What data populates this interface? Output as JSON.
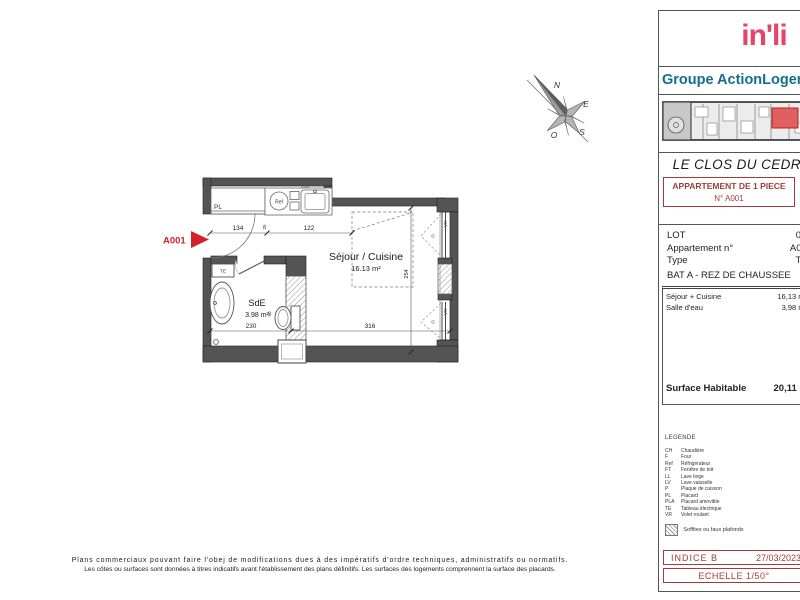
{
  "header": {
    "logo_text": "in'li",
    "logo_badge": "AL",
    "group_name": "Groupe ActionLogement"
  },
  "doc": {
    "project_title": "LE CLOS DU CEDRE",
    "apt_line1": "APPARTEMENT DE 1 PIECE",
    "apt_line2": "N° A001"
  },
  "info": {
    "lot_label": "LOT",
    "lot_value": "01",
    "apt_label": "Appartement n°",
    "apt_value": "A001",
    "type_label": "Type",
    "type_value": "T1",
    "bat_line": "BAT A - REZ DE CHAUSSEE"
  },
  "surfaces": {
    "rows": [
      {
        "label": "Séjour + Cuisine",
        "value": "16,13 m²"
      },
      {
        "label": "Salle d'eau",
        "value": "3,98 m²"
      }
    ],
    "total_label": "Surface Habitable",
    "total_value": "20,11 m²"
  },
  "legend": {
    "title": "LEGENDE",
    "items": [
      {
        "code": "CH",
        "label": "Chaudière"
      },
      {
        "code": "F",
        "label": "Four"
      },
      {
        "code": "Ref",
        "label": "Réfrigérateur"
      },
      {
        "code": "FT",
        "label": "Fenêtre de toit"
      },
      {
        "code": "LL",
        "label": "Lave linge"
      },
      {
        "code": "LV",
        "label": "Lave vaisselle"
      },
      {
        "code": "P",
        "label": "Plaque de cuisson"
      },
      {
        "code": "PL",
        "label": "Placard"
      },
      {
        "code": "PLA",
        "label": "Placard amovible"
      },
      {
        "code": "TE",
        "label": "Tableau électrique"
      },
      {
        "code": "VR",
        "label": "Volet roulant"
      }
    ],
    "soffites": "Soffites ou faux plafonds"
  },
  "revision": {
    "indice": "INDICE  B",
    "date": "27/03/2023",
    "echelle": "ECHELLE 1/50°"
  },
  "disclaimer": {
    "line1": "Plans commerciaux pouvant faire l'obej de modifications dues à des impératifs d'ordre techniques, administratifs ou normatifs.",
    "line2": "Les côtes ou surfaces sont données à titres indicatifs avant l'établissement des plans définitifs. Les surfaces des logements comprennent la surface des placards."
  },
  "plan": {
    "unit": "A001",
    "sejour_name": "Séjour / Cuisine",
    "sejour_area": "16.13 m²",
    "sde_name": "SdE",
    "sde_area": "3.98 m²",
    "labels": {
      "pl": "PL",
      "ref": "Ref",
      "te": "TE",
      "vr": "VR",
      "tag": "V08"
    },
    "dims": {
      "d134": "134",
      "d122": "122",
      "d25": "25",
      "d230": "230",
      "d316": "316",
      "d254": "254",
      "d90": "90"
    }
  },
  "compass": {
    "n": "N",
    "e": "E",
    "s": "S",
    "o": "O"
  }
}
